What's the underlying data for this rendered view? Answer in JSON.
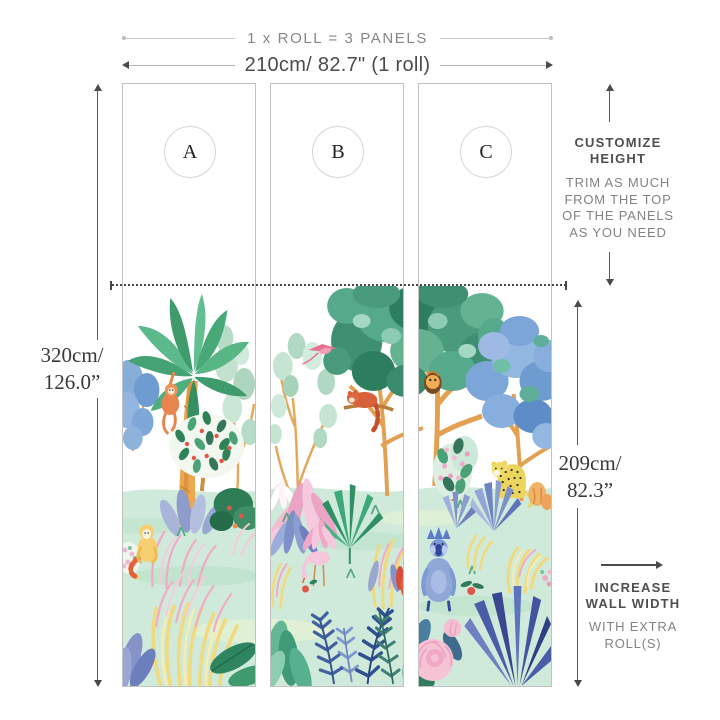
{
  "title": "Wallpaper roll panel sizing diagram",
  "header": {
    "roll_equation": "1 x ROLL = 3 PANELS",
    "roll_width_label": "210cm/ 82.7\" (1 roll)"
  },
  "panels": [
    {
      "label": "A"
    },
    {
      "label": "B"
    },
    {
      "label": "C"
    }
  ],
  "dimensions": {
    "wall_height_lines": [
      "320cm/",
      "126.0”"
    ],
    "artwork_height_lines": [
      "209cm/",
      "82.3”"
    ]
  },
  "annotations": {
    "customize_title_lines": [
      "CUSTOMIZE",
      "HEIGHT"
    ],
    "customize_body_lines": [
      "TRIM AS MUCH",
      "FROM THE TOP",
      "OF THE PANELS",
      "AS YOU NEED"
    ],
    "increase_title_lines": [
      "INCREASE",
      "WALL WIDTH"
    ],
    "increase_body_lines": [
      "WITH EXTRA",
      "ROLL(S)"
    ]
  },
  "artwork": {
    "description": "Watercolor jungle mural spanning the three panels",
    "animals": [
      "orangutan",
      "golden-monkey",
      "pink-bird",
      "red-panda",
      "owl",
      "pink-crane",
      "leopard",
      "mandrill"
    ],
    "plants": [
      "palm-tree",
      "blue-bush",
      "pale-eucalyptus",
      "teal-tree",
      "blue-tree",
      "fruit-tree",
      "pink-palms",
      "fan-palm",
      "ferns",
      "blue-agave",
      "peony",
      "yellow-grass",
      "pink-grass",
      "navy-spiky-bush"
    ]
  },
  "colors": {
    "dimension_line": "#4a4a4a",
    "light_line": "#c9c9c9",
    "text_dark": "#4f4f4f",
    "text_light": "#878787",
    "ground_mint": "#cfeada",
    "teal_foliage": "#3f8f72",
    "blue_foliage": "#7ca6d8",
    "trunk_orange": "#e2a050",
    "accent_pink": "#f2aac6",
    "accent_yellow": "#f1d97c"
  }
}
